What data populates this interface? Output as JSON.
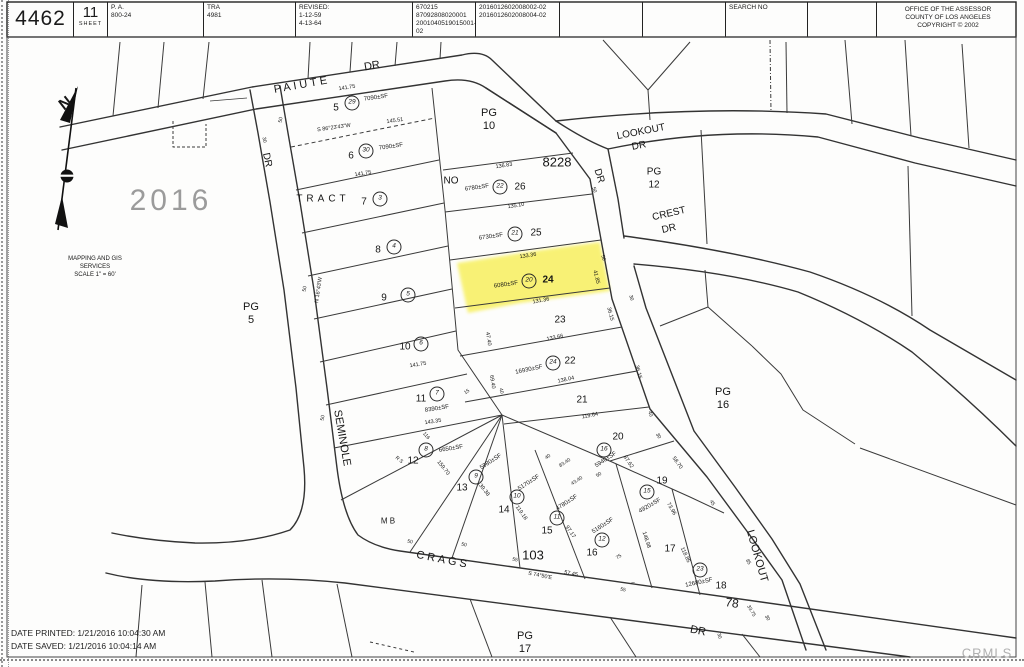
{
  "header": {
    "book": "4462",
    "sheet_number": "11",
    "sheet_label": "SHEET",
    "pa_label": "P. A.",
    "pa_value": "800-24",
    "tra_label": "TRA",
    "tra_value": "4981",
    "revised_label": "REVISED:",
    "revised1": "1-12-59",
    "revised2": "4-13-64",
    "doc1": "670215",
    "doc2": "87092808020001",
    "doc3": "2001040519015001-02",
    "ref1": "2016012602008002-02",
    "ref2": "2016012602008004-02",
    "search_label": "SEARCH NO",
    "office1": "OFFICE OF THE ASSESSOR",
    "office2": "COUNTY OF LOS ANGELES",
    "office3": "COPYRIGHT © 2002"
  },
  "footer": {
    "printed": "DATE PRINTED: 1/21/2016 10:04:30 AM",
    "saved": "DATE SAVED: 1/21/2016 10:04:14 AM",
    "watermark": "CRMLS"
  },
  "map": {
    "tract": "TRACT NO 8228",
    "highlighted_parcel": "24",
    "highlight_color": "#f6ec2e",
    "labels": [
      {
        "t": "PAIUTE",
        "x": 302,
        "y": 85,
        "s": 11,
        "r": -10,
        "ls": 3,
        "n": "street-label-paiute"
      },
      {
        "t": "DR",
        "x": 372,
        "y": 66,
        "s": 11,
        "r": -10,
        "n": "street-label-paiute-dr"
      },
      {
        "t": "DR",
        "x": 267,
        "y": 160,
        "s": 10,
        "r": 78,
        "n": "street-label-seminole-dr"
      },
      {
        "t": "SEMINOLE",
        "x": 342,
        "y": 438,
        "s": 11,
        "r": 80,
        "n": "street-label-seminole"
      },
      {
        "t": "LOOKOUT",
        "x": 641,
        "y": 132,
        "s": 10,
        "r": -11,
        "n": "street-label-lookout"
      },
      {
        "t": "DR",
        "x": 639,
        "y": 146,
        "s": 10,
        "r": -11,
        "n": "street-label-lookout-dr"
      },
      {
        "t": "DR",
        "x": 599,
        "y": 176,
        "s": 10,
        "r": 72,
        "n": "street-label-dr"
      },
      {
        "t": "CREST",
        "x": 669,
        "y": 214,
        "s": 10,
        "r": -13,
        "n": "street-label-crest"
      },
      {
        "t": "DR",
        "x": 669,
        "y": 229,
        "s": 10,
        "r": -13,
        "n": "street-label-crest-dr"
      },
      {
        "t": "LOOKOUT",
        "x": 757,
        "y": 556,
        "s": 11,
        "r": 74,
        "n": "street-label-lookout-south"
      },
      {
        "t": "CRAGS",
        "x": 443,
        "y": 560,
        "s": 11,
        "r": 11,
        "ls": 3,
        "n": "street-label-crags"
      },
      {
        "t": "DR",
        "x": 698,
        "y": 631,
        "s": 11,
        "r": 11,
        "n": "street-label-crags-dr"
      },
      {
        "t": "TRACT",
        "x": 323,
        "y": 199,
        "s": 10,
        "ls": 4,
        "n": "tract-label"
      },
      {
        "t": "NO",
        "x": 451,
        "y": 181,
        "s": 10,
        "n": "tract-label"
      },
      {
        "t": "8228",
        "x": 557,
        "y": 162,
        "s": 13,
        "n": "tract-number"
      },
      {
        "t": "PG",
        "x": 489,
        "y": 113,
        "s": 11,
        "n": "page-ref"
      },
      {
        "t": "10",
        "x": 489,
        "y": 126,
        "s": 11,
        "n": "page-ref"
      },
      {
        "t": "PG",
        "x": 654,
        "y": 172,
        "s": 10,
        "n": "page-ref"
      },
      {
        "t": "12",
        "x": 654,
        "y": 185,
        "s": 10,
        "n": "page-ref"
      },
      {
        "t": "PG",
        "x": 723,
        "y": 392,
        "s": 11,
        "n": "page-ref"
      },
      {
        "t": "16",
        "x": 723,
        "y": 405,
        "s": 11,
        "n": "page-ref"
      },
      {
        "t": "PG",
        "x": 525,
        "y": 636,
        "s": 11,
        "n": "page-ref"
      },
      {
        "t": "17",
        "x": 525,
        "y": 649,
        "s": 11,
        "n": "page-ref"
      },
      {
        "t": "PG",
        "x": 251,
        "y": 307,
        "s": 11,
        "n": "page-ref"
      },
      {
        "t": "5",
        "x": 251,
        "y": 320,
        "s": 11,
        "n": "page-ref"
      },
      {
        "t": "2016",
        "x": 171,
        "y": 201,
        "s": 30,
        "c": "wm",
        "n": "book-watermark"
      },
      {
        "t": "N",
        "x": 66,
        "y": 104,
        "s": 16,
        "r": -38,
        "c": "b",
        "n": "compass-north-label"
      },
      {
        "t": "MAPPING AND GIS",
        "x": 95,
        "y": 259,
        "s": 6,
        "n": "gis-note"
      },
      {
        "t": "SERVICES",
        "x": 95,
        "y": 267,
        "s": 6,
        "n": "gis-note"
      },
      {
        "t": "SCALE 1\" = 60'",
        "x": 95,
        "y": 275,
        "s": 6,
        "n": "map-scale"
      },
      {
        "t": "5",
        "x": 336,
        "y": 108,
        "s": 10,
        "n": "parcel-number"
      },
      {
        "t": "6",
        "x": 351,
        "y": 156,
        "s": 10,
        "n": "parcel-number"
      },
      {
        "t": "7",
        "x": 364,
        "y": 202,
        "s": 10,
        "n": "parcel-number"
      },
      {
        "t": "8",
        "x": 378,
        "y": 250,
        "s": 10,
        "n": "parcel-number"
      },
      {
        "t": "9",
        "x": 384,
        "y": 298,
        "s": 10,
        "n": "parcel-number"
      },
      {
        "t": "10",
        "x": 405,
        "y": 347,
        "s": 10,
        "n": "parcel-number"
      },
      {
        "t": "11",
        "x": 421,
        "y": 399,
        "s": 10,
        "n": "parcel-number"
      },
      {
        "t": "12",
        "x": 413,
        "y": 461,
        "s": 10,
        "n": "parcel-number"
      },
      {
        "t": "13",
        "x": 462,
        "y": 488,
        "s": 10,
        "n": "parcel-number"
      },
      {
        "t": "14",
        "x": 504,
        "y": 510,
        "s": 10,
        "n": "parcel-number"
      },
      {
        "t": "15",
        "x": 547,
        "y": 531,
        "s": 10,
        "n": "parcel-number"
      },
      {
        "t": "16",
        "x": 592,
        "y": 553,
        "s": 10,
        "n": "parcel-number"
      },
      {
        "t": "17",
        "x": 670,
        "y": 549,
        "s": 10,
        "n": "parcel-number"
      },
      {
        "t": "18",
        "x": 721,
        "y": 586,
        "s": 10,
        "n": "parcel-number"
      },
      {
        "t": "19",
        "x": 662,
        "y": 481,
        "s": 10,
        "n": "parcel-number"
      },
      {
        "t": "20",
        "x": 618,
        "y": 437,
        "s": 10,
        "n": "parcel-number"
      },
      {
        "t": "21",
        "x": 582,
        "y": 400,
        "s": 10,
        "n": "parcel-number"
      },
      {
        "t": "22",
        "x": 570,
        "y": 361,
        "s": 10,
        "n": "parcel-number"
      },
      {
        "t": "23",
        "x": 560,
        "y": 320,
        "s": 10,
        "n": "parcel-number"
      },
      {
        "t": "24",
        "x": 548,
        "y": 280,
        "s": 10,
        "c": "b",
        "n": "parcel-number-highlighted"
      },
      {
        "t": "25",
        "x": 536,
        "y": 233,
        "s": 10,
        "n": "parcel-number"
      },
      {
        "t": "26",
        "x": 520,
        "y": 187,
        "s": 10,
        "n": "parcel-number"
      },
      {
        "t": "103",
        "x": 533,
        "y": 555,
        "s": 13,
        "n": "lot-number"
      },
      {
        "t": "78",
        "x": 732,
        "y": 603,
        "s": 12,
        "r": 8,
        "n": "lot-number"
      },
      {
        "t": "M B",
        "x": 388,
        "y": 521,
        "s": 8,
        "n": "mb-label"
      },
      {
        "t": "7090±SF",
        "x": 376,
        "y": 98,
        "s": 6,
        "r": -8,
        "n": "area-label"
      },
      {
        "t": "7090±SF",
        "x": 391,
        "y": 147,
        "s": 6,
        "r": -8,
        "n": "area-label"
      },
      {
        "t": "6780±SF",
        "x": 477,
        "y": 188,
        "s": 6,
        "r": -8,
        "n": "area-label"
      },
      {
        "t": "6730±SF",
        "x": 491,
        "y": 237,
        "s": 6,
        "r": -8,
        "n": "area-label"
      },
      {
        "t": "6080±SF",
        "x": 506,
        "y": 285,
        "s": 6,
        "r": -8,
        "n": "area-label"
      },
      {
        "t": "16930±SF",
        "x": 529,
        "y": 370,
        "s": 6,
        "r": -12,
        "n": "area-label"
      },
      {
        "t": "8390±SF",
        "x": 437,
        "y": 409,
        "s": 6,
        "r": -9,
        "n": "area-label"
      },
      {
        "t": "6650±SF",
        "x": 451,
        "y": 449,
        "s": 6,
        "r": -9,
        "n": "area-label"
      },
      {
        "t": "5980±SF",
        "x": 491,
        "y": 462,
        "s": 6,
        "r": -33,
        "n": "area-label"
      },
      {
        "t": "5170±SF",
        "x": 529,
        "y": 483,
        "s": 6,
        "r": -33,
        "n": "area-label"
      },
      {
        "t": "4780±SF",
        "x": 567,
        "y": 503,
        "s": 6,
        "r": -33,
        "n": "area-label"
      },
      {
        "t": "5160±SF",
        "x": 603,
        "y": 526,
        "s": 6,
        "r": -33,
        "n": "area-label"
      },
      {
        "t": "5940±SF",
        "x": 606,
        "y": 460,
        "s": 6,
        "r": -33,
        "n": "area-label"
      },
      {
        "t": "4920±SF",
        "x": 650,
        "y": 506,
        "s": 6,
        "r": -30,
        "n": "area-label"
      },
      {
        "t": "12680±SF",
        "x": 699,
        "y": 583,
        "s": 6,
        "r": -12,
        "n": "area-label"
      },
      {
        "t": "141.75",
        "x": 347,
        "y": 88,
        "s": 5.5,
        "r": -9,
        "n": "dimension"
      },
      {
        "t": "S 86°23'43\"W",
        "x": 334,
        "y": 128,
        "s": 5.5,
        "r": -8,
        "n": "bearing"
      },
      {
        "t": "145.51",
        "x": 395,
        "y": 121,
        "s": 5.5,
        "r": -8,
        "n": "dimension"
      },
      {
        "t": "141.75",
        "x": 363,
        "y": 174,
        "s": 5.5,
        "r": -9,
        "n": "dimension"
      },
      {
        "t": "141.75",
        "x": 418,
        "y": 365,
        "s": 5.5,
        "r": -9,
        "n": "dimension"
      },
      {
        "t": "143.35",
        "x": 433,
        "y": 422,
        "s": 5.5,
        "r": -9,
        "n": "dimension"
      },
      {
        "t": "136.83",
        "x": 504,
        "y": 166,
        "s": 5.5,
        "r": -9,
        "n": "dimension"
      },
      {
        "t": "135.10",
        "x": 516,
        "y": 206,
        "s": 5.5,
        "r": -9,
        "n": "dimension"
      },
      {
        "t": "133.36",
        "x": 528,
        "y": 256,
        "s": 5.5,
        "r": -9,
        "n": "dimension"
      },
      {
        "t": "131.36",
        "x": 541,
        "y": 301,
        "s": 5.5,
        "r": -10,
        "n": "dimension"
      },
      {
        "t": "41.85",
        "x": 596,
        "y": 277,
        "s": 5.5,
        "r": 76,
        "n": "dimension"
      },
      {
        "t": "133.66",
        "x": 555,
        "y": 338,
        "s": 5.5,
        "r": -12,
        "n": "dimension"
      },
      {
        "t": "138.04",
        "x": 566,
        "y": 380,
        "s": 5.5,
        "r": -12,
        "n": "dimension"
      },
      {
        "t": "119.64",
        "x": 590,
        "y": 416,
        "s": 5.5,
        "r": -11,
        "n": "dimension"
      },
      {
        "t": "159.70",
        "x": 443,
        "y": 468,
        "s": 5.5,
        "r": 52,
        "n": "dimension"
      },
      {
        "t": "139.38",
        "x": 483,
        "y": 489,
        "s": 5.5,
        "r": 52,
        "n": "dimension"
      },
      {
        "t": "119.18",
        "x": 521,
        "y": 513,
        "s": 5.5,
        "r": 55,
        "n": "dimension"
      },
      {
        "t": "97.17",
        "x": 570,
        "y": 532,
        "s": 5.5,
        "r": 55,
        "n": "dimension"
      },
      {
        "t": "148.98",
        "x": 646,
        "y": 540,
        "s": 5.5,
        "r": 72,
        "n": "dimension"
      },
      {
        "t": "118.85",
        "x": 685,
        "y": 555,
        "s": 5.5,
        "r": 65,
        "n": "dimension"
      },
      {
        "t": "87.62",
        "x": 628,
        "y": 462,
        "s": 5.5,
        "r": 55,
        "n": "dimension"
      },
      {
        "t": "73.96",
        "x": 671,
        "y": 509,
        "s": 5.5,
        "r": 60,
        "n": "dimension"
      },
      {
        "t": "58.70",
        "x": 677,
        "y": 463,
        "s": 5.5,
        "r": 55,
        "n": "dimension"
      },
      {
        "t": "57.45",
        "x": 571,
        "y": 574,
        "s": 5.5,
        "r": 11,
        "n": "dimension"
      },
      {
        "t": "S 74°50'E",
        "x": 540,
        "y": 576,
        "s": 5.5,
        "r": 11,
        "n": "bearing"
      },
      {
        "t": "N 16°43'W",
        "x": 319,
        "y": 290,
        "s": 5.5,
        "r": -82,
        "n": "bearing"
      },
      {
        "t": "116",
        "x": 426,
        "y": 436,
        "s": 5,
        "r": 50,
        "n": "dimension"
      },
      {
        "t": "R S",
        "x": 399,
        "y": 460,
        "s": 5,
        "r": 40,
        "n": "survey-ref"
      },
      {
        "t": "15",
        "x": 467,
        "y": 392,
        "s": 5,
        "r": -33,
        "n": "dimension"
      },
      {
        "t": "47.40",
        "x": 488,
        "y": 339,
        "s": 5.5,
        "r": 80,
        "n": "dimension"
      },
      {
        "t": "69.40",
        "x": 492,
        "y": 382,
        "s": 5.5,
        "r": 80,
        "n": "dimension"
      },
      {
        "t": "40",
        "x": 501,
        "y": 391,
        "s": 5,
        "r": 80,
        "n": "dimension"
      },
      {
        "t": "36.15",
        "x": 610,
        "y": 314,
        "s": 5.5,
        "r": 75,
        "n": "dimension"
      },
      {
        "t": "36.15",
        "x": 638,
        "y": 372,
        "s": 5.5,
        "r": 75,
        "n": "dimension"
      },
      {
        "t": "40",
        "x": 650,
        "y": 414,
        "s": 5,
        "r": 70,
        "n": "dimension"
      },
      {
        "t": "30",
        "x": 658,
        "y": 436,
        "s": 5,
        "r": 60,
        "n": "dimension"
      },
      {
        "t": "45",
        "x": 712,
        "y": 503,
        "s": 5,
        "r": 60,
        "n": "dimension"
      },
      {
        "t": "85",
        "x": 748,
        "y": 562,
        "s": 5,
        "r": 60,
        "n": "dimension"
      },
      {
        "t": "30",
        "x": 767,
        "y": 618,
        "s": 5,
        "r": 60,
        "n": "dimension"
      },
      {
        "t": "33.75",
        "x": 751,
        "y": 611,
        "s": 5,
        "r": 60,
        "n": "dimension"
      },
      {
        "t": "75",
        "x": 619,
        "y": 557,
        "s": 5,
        "r": -33,
        "n": "dimension"
      },
      {
        "t": "55",
        "x": 515,
        "y": 560,
        "s": 5,
        "r": 11,
        "n": "dimension"
      },
      {
        "t": "55",
        "x": 623,
        "y": 590,
        "s": 5,
        "r": 11,
        "n": "dimension"
      },
      {
        "t": "50",
        "x": 464,
        "y": 545,
        "s": 5,
        "r": 11,
        "n": "dimension"
      },
      {
        "t": "50",
        "x": 410,
        "y": 542,
        "s": 5,
        "r": 11,
        "n": "dimension"
      },
      {
        "t": "30",
        "x": 719,
        "y": 636,
        "s": 5,
        "r": 75,
        "n": "dimension"
      },
      {
        "t": "50",
        "x": 281,
        "y": 120,
        "s": 5,
        "r": -80,
        "n": "dimension"
      },
      {
        "t": "50",
        "x": 305,
        "y": 289,
        "s": 5,
        "r": -80,
        "n": "dimension"
      },
      {
        "t": "50",
        "x": 323,
        "y": 418,
        "s": 5,
        "r": -80,
        "n": "dimension"
      },
      {
        "t": "30",
        "x": 264,
        "y": 140,
        "s": 5,
        "r": 80,
        "n": "dimension"
      },
      {
        "t": "50",
        "x": 594,
        "y": 190,
        "s": 5,
        "r": 72,
        "n": "dimension"
      },
      {
        "t": "50",
        "x": 603,
        "y": 258,
        "s": 5,
        "r": 72,
        "n": "dimension"
      },
      {
        "t": "30",
        "x": 631,
        "y": 298,
        "s": 5,
        "r": 72,
        "n": "dimension"
      },
      {
        "t": "40",
        "x": 548,
        "y": 457,
        "s": 5,
        "r": -33,
        "n": "dimension"
      },
      {
        "t": "83.40",
        "x": 565,
        "y": 463,
        "s": 5,
        "r": -33,
        "n": "dimension"
      },
      {
        "t": "43.40",
        "x": 577,
        "y": 481,
        "s": 5,
        "r": -33,
        "n": "dimension"
      },
      {
        "t": "50",
        "x": 599,
        "y": 475,
        "s": 5,
        "r": -33,
        "n": "dimension"
      },
      {
        "t": "–",
        "x": 633,
        "y": 583,
        "s": 6,
        "n": "tick-mark"
      }
    ],
    "circles": [
      {
        "n": "29",
        "x": 352,
        "y": 103
      },
      {
        "n": "30",
        "x": 366,
        "y": 151
      },
      {
        "n": "3",
        "x": 380,
        "y": 199
      },
      {
        "n": "4",
        "x": 394,
        "y": 247
      },
      {
        "n": "5",
        "x": 408,
        "y": 295
      },
      {
        "n": "6",
        "x": 421,
        "y": 344
      },
      {
        "n": "7",
        "x": 437,
        "y": 394
      },
      {
        "n": "8",
        "x": 426,
        "y": 450
      },
      {
        "n": "9",
        "x": 476,
        "y": 477
      },
      {
        "n": "10",
        "x": 517,
        "y": 497
      },
      {
        "n": "11",
        "x": 557,
        "y": 518
      },
      {
        "n": "12",
        "x": 602,
        "y": 540
      },
      {
        "n": "15",
        "x": 647,
        "y": 492
      },
      {
        "n": "16",
        "x": 604,
        "y": 450
      },
      {
        "n": "23",
        "x": 700,
        "y": 570
      },
      {
        "n": "24",
        "x": 553,
        "y": 363
      },
      {
        "n": "20",
        "x": 529,
        "y": 281
      },
      {
        "n": "21",
        "x": 515,
        "y": 234
      },
      {
        "n": "22",
        "x": 500,
        "y": 187
      }
    ]
  }
}
